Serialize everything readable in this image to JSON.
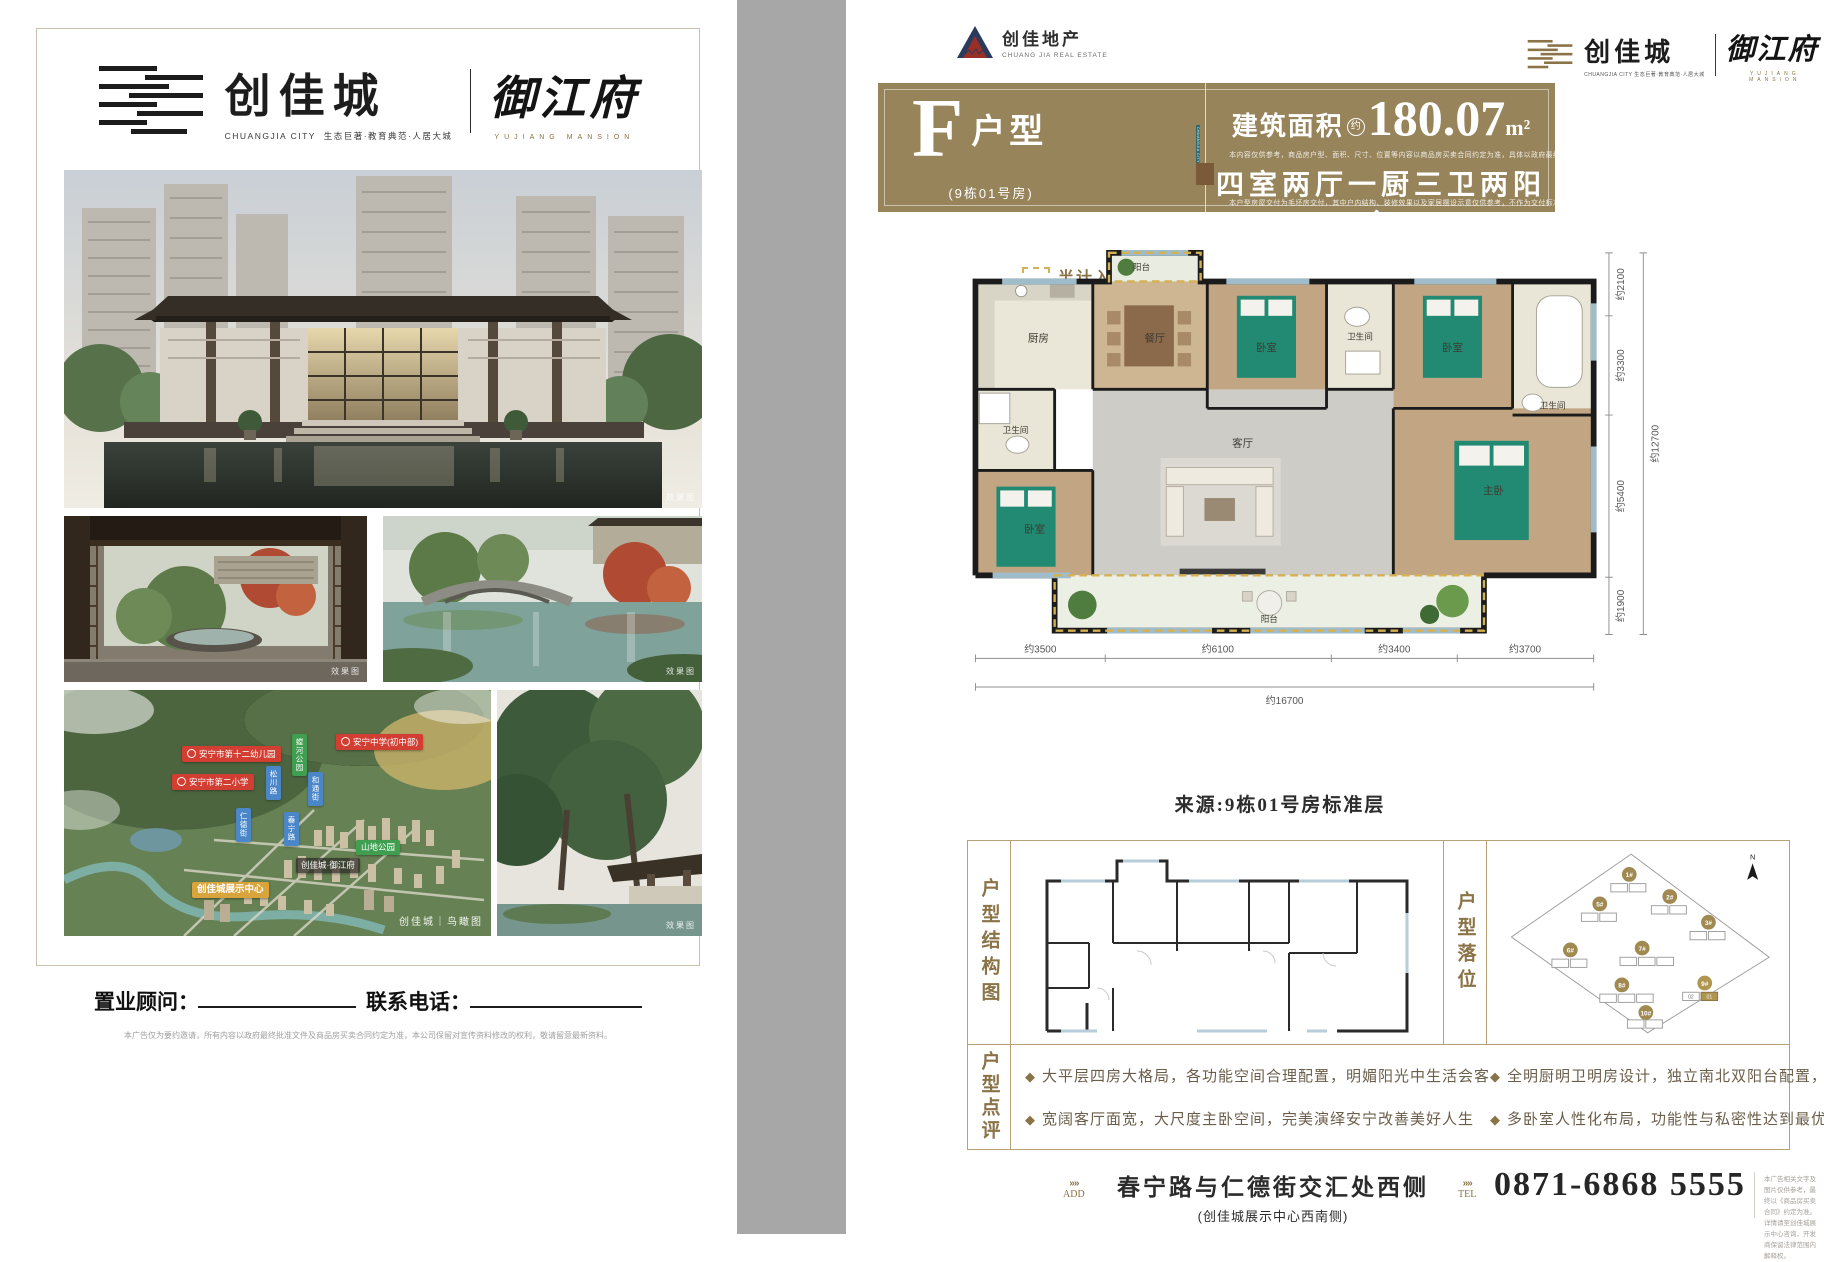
{
  "brand": {
    "name_cn": "创佳城",
    "name_en": "CHUANGJIA CITY",
    "tagline": "生态巨著·教育典范·人居大城",
    "mansion_cn": "御江府",
    "mansion_en": "YUJIANG MANSION",
    "developer_cn": "创佳地产",
    "developer_en": "CHUANG JIA REAL ESTATE"
  },
  "left_page": {
    "photo_tags": {
      "hero": "效果图",
      "courtyard": "效果图",
      "garden": "效果图",
      "detail": "效果图"
    },
    "map": {
      "schools": [
        "安宁市第十二幼儿园",
        "安宁市第二小学",
        "安宁中学(初中部)"
      ],
      "streets": [
        "松川路",
        "和通街",
        "仁德街",
        "春宁路"
      ],
      "parks": [
        "螳河公园",
        "山地公园"
      ],
      "center_tag": "创佳城展示中心",
      "project_tag": "创佳城·御江府",
      "watermark": "创佳城｜鸟瞰图"
    },
    "footer": {
      "consultant_label": "置业顾问：",
      "phone_label": "联系电话：",
      "disclaimer": "本广告仅为要约邀请，所有内容以政府最终批准文件及商品房买卖合同约定为准，本公司保留对宣传资料修改的权利，敬请留意最新资料。"
    }
  },
  "right_page": {
    "unit": {
      "letter": "F",
      "type_label": "户型",
      "sub_label": "(9栋01号房)",
      "ribbon": "CHUANGJIA CITY",
      "area_label": "建筑面积",
      "approx": "约",
      "area_value": "180.07",
      "area_unit": "m²",
      "area_note": "本内容仅供参考，商品房户型、面积、尺寸、位置等内容以商品房买卖合同约定为准，具体以政府最终批准文件为准",
      "layout_text": "四室两厅一厨三卫两阳台",
      "layout_note": "本户型房屋交付为毛坯房交付，其中户内结构、装修效果以及家居摆设示意仅供参考，不作为交付标准"
    },
    "legend": "半计入产权面积",
    "floorplan": {
      "rooms": {
        "balcony_top": "阳台",
        "kitchen": "厨房",
        "dining": "餐厅",
        "bed1": "卧室",
        "bath1": "卫生间",
        "bed2": "卧室",
        "bath3": "卫生间",
        "bath2": "卫生间",
        "bed3": "卧室",
        "living": "客厅",
        "master": "主卧",
        "balcony_bottom": "阳台"
      },
      "dims_right": [
        "约2100",
        "约3300",
        "约5400",
        "约1900"
      ],
      "dims_right_total": "约12700",
      "dims_bottom": [
        "约3500",
        "约6100",
        "约3400",
        "约3700"
      ],
      "dims_bottom_total": "约16700",
      "source": "来源:9栋01号房标准层"
    },
    "sections": {
      "structure_label": "户型结构图",
      "position_label": "户型落位",
      "review_label": "户型点评"
    },
    "site": {
      "buildings": [
        "1#",
        "2#",
        "3#",
        "5#",
        "6#",
        "7#",
        "8#",
        "9#",
        "10#"
      ],
      "unit_highlight": "01",
      "unit_secondary": "02",
      "north": "N"
    },
    "review": [
      "大平层四房大格局，各功能空间合理配置，明媚阳光中生活会客",
      "宽阔客厅面宽，大尺度主卧空间，完美演绎安宁改善美好人生",
      "全明厨明卫明房设计，独立南北双阳台配置，尽显居家生活品质",
      "多卧室人性化布局，功能性与私密性达到最优，阖绰方便岂止一点点"
    ],
    "footer": {
      "add_label": "ADD",
      "address": "春宁路与仁德街交汇处西侧",
      "address_sub": "(创佳城展示中心西南侧)",
      "tel_label": "TEL",
      "phone": "0871-6868 5555",
      "disclaimer_1": "本广告相关文字及图片仅供参考，最终以《商品房买卖合同》约定为准。",
      "disclaimer_2": "详情请至创佳城展示中心咨询，开发商保留法律范围内解释权。"
    }
  }
}
